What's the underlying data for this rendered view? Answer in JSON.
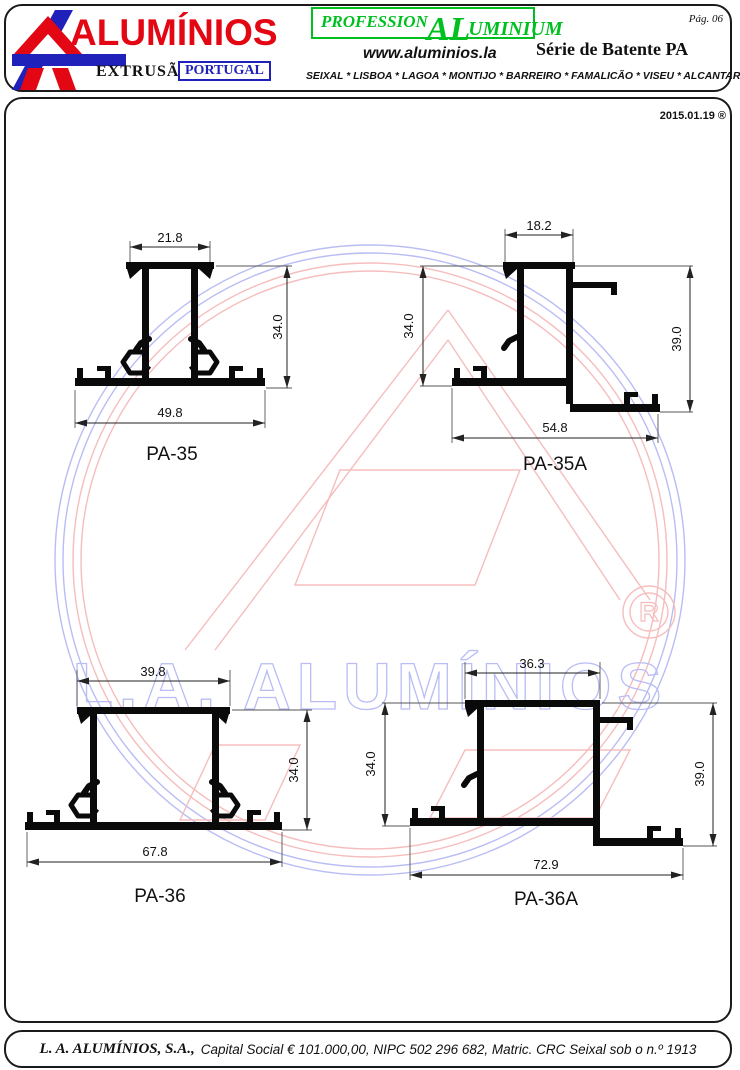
{
  "header": {
    "brand_name": "ALUMÍNIOS",
    "brand_sub": "EXTRUSÃO",
    "brand_country": "PORTUGAL",
    "professional_prefix": "PROFESSION",
    "professional_al": "AL",
    "professional_suffix": "UMINIUM",
    "page_number": "Pág. 06",
    "website": "www.aluminios.la",
    "series_title": "Série de Batente PA",
    "locations": "SEIXAL * LISBOA * LAGOA * MONTIJO * BARREIRO * FAMALICÃO * VISEU * ALCANTARILHA"
  },
  "sheet": {
    "date": "2015.01.19 ®",
    "watermark_text": "L.A. ALUMÍNIOS",
    "watermark_symbol": "R"
  },
  "profiles": [
    {
      "label": "PA-35",
      "top_width": "21.8",
      "height_right": "34.0",
      "bottom_width": "49.8"
    },
    {
      "label": "PA-35A",
      "top_width": "18.2",
      "height_left": "34.0",
      "height_right": "39.0",
      "bottom_width": "54.8"
    },
    {
      "label": "PA-36",
      "top_width": "39.8",
      "height_right": "34.0",
      "bottom_width": "67.8"
    },
    {
      "label": "PA-36A",
      "top_width": "36.3",
      "height_left": "34.0",
      "height_right": "39.0",
      "bottom_width": "72.9"
    }
  ],
  "footer": {
    "company": "L. A. ALUMÍNIOS, S.A.,",
    "registration": "Capital Social € 101.000,00, NIPC 502 296 682, Matric. CRC Seixal sob o n.º 1913"
  },
  "colors": {
    "brand_red": "#e30613",
    "brand_blue": "#2020bb",
    "brand_green": "#00c020",
    "watermark_red": "#f6bdbd",
    "watermark_blue": "#b9bdf4",
    "line_black": "#0a0a0a"
  }
}
